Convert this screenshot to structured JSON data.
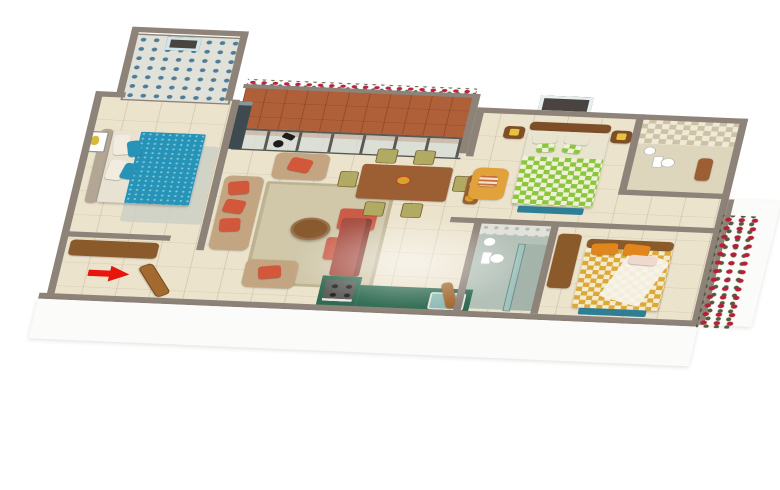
{
  "scene": {
    "background_color": "#ffffff",
    "wall_top_color": "#8e8379",
    "wall_face_color": "#fbfbf9",
    "floor_tile_color": "#ece3cd",
    "floor_grout_color": "#d8cdb2"
  },
  "entrance": {
    "arrow_color": "#e8150d",
    "door_color": "#a4692f"
  },
  "rooms": {
    "bathroom_top_left": {
      "tile_base": "#e0e1d9",
      "tile_blue": "#4f7d99",
      "tile_orange": "#c07b3a",
      "window_frame": "#4a4440"
    },
    "bedroom_left": {
      "duvet": "#2793b7",
      "duvet_dot": "#7cc8de",
      "pillow": "#f1ecdf",
      "headboard": "#b3a694",
      "rug": "#ccd0c5",
      "art_accent": "#d8b93a",
      "wardrobe": "#8a5a2b",
      "window_glass": "#3e4a50"
    },
    "living_room": {
      "sofa": "#c4a582",
      "cushion": "#d2573b",
      "coffee_table": "#8a5a2f",
      "ottoman": "#cd5c47",
      "rug": "#cfc6a7",
      "lamp": "#1d1d1b"
    },
    "balcony": {
      "floor": "#b06038",
      "flower": "#c11f45",
      "leaf": "#5c6e44",
      "glass_frame": "#5b5953",
      "glass_tint": "#d7ded8"
    },
    "dining": {
      "table": "#9c5e33",
      "chair": "#9c5e33",
      "seat": "#b1aa62",
      "vase_flowers": "#d8a427"
    },
    "kitchen": {
      "counter": "#2f6b52",
      "stove": "#5c5c5a",
      "fridge": "#a84f43",
      "sink": "#8fbcb4",
      "cabinet": "#9c5e33"
    },
    "bathroom_middle": {
      "wall_tile": "#e2e2dc",
      "floor": "#b3c1b8",
      "fixture": "#ffffff",
      "shower_glass": "#9ec7c0"
    },
    "bedroom_top_right": {
      "bed_checker_a": "#8cc63f",
      "bed_checker_b": "#eef0d8",
      "sheet": "#e9e4cf",
      "bench": "#2e7f96",
      "armchair": "#e2a23b",
      "nightstand": "#7d4e27",
      "lamp_shade": "#e8c23a",
      "window_frame": "#4a4440"
    },
    "bathroom_top_right": {
      "tile_a": "#cdc2a4",
      "tile_b": "#efe9d7",
      "fixture": "#ffffff",
      "cabinet": "#9c5e33"
    },
    "bedroom_bottom_right": {
      "bed_checker_a": "#dca836",
      "bed_checker_b": "#f3ead0",
      "pillow": "#e0861c",
      "blanket": "#efd9cd",
      "throw": "#f6f3ea",
      "headboard": "#8a5a2b",
      "bench": "#2e7f96",
      "wardrobe": "#8a5a2b"
    },
    "exterior": {
      "climbing_flower": "#b51f3a",
      "leaf": "#4e5e38"
    }
  }
}
